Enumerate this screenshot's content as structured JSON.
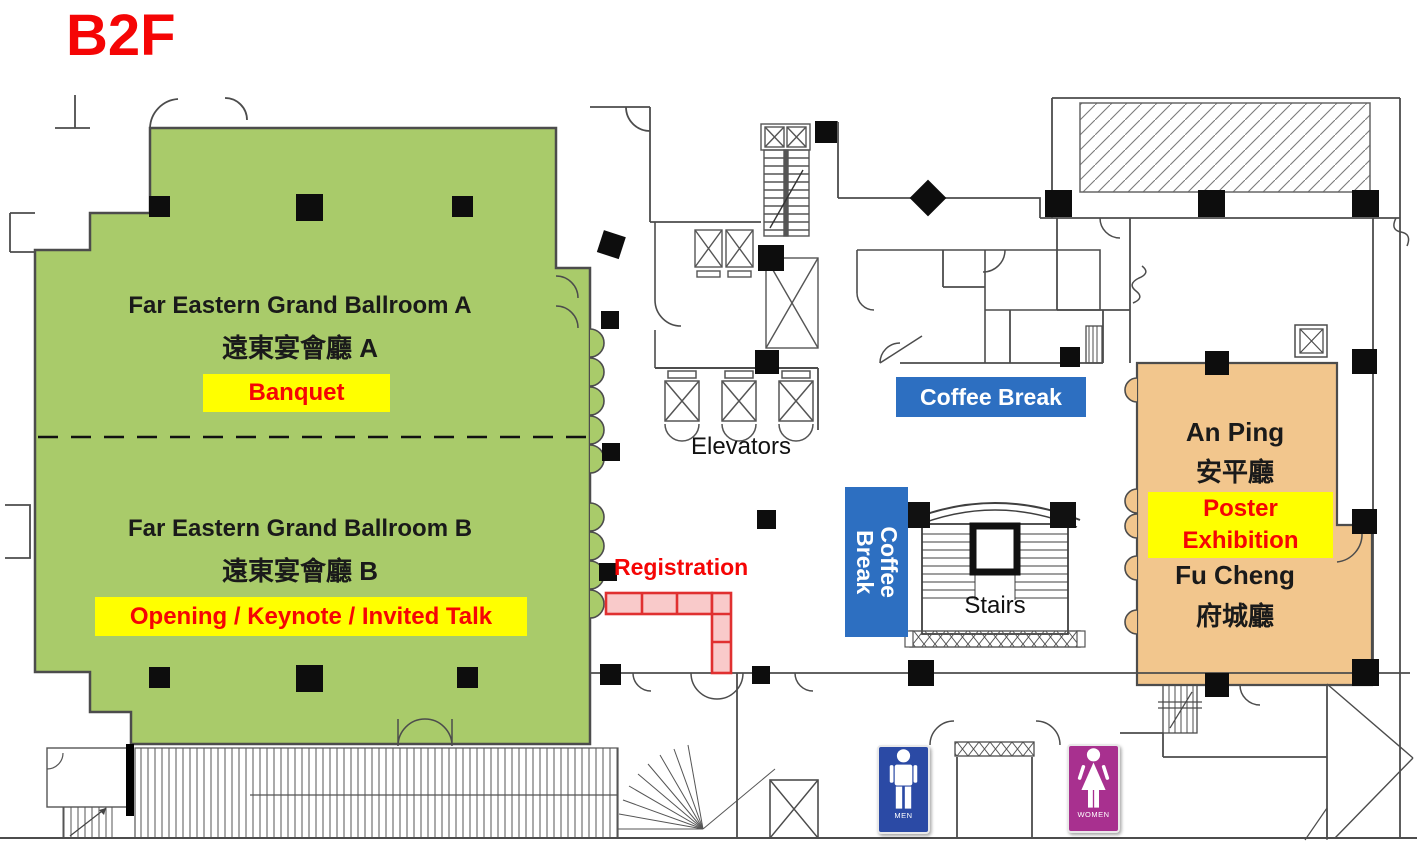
{
  "floor_label": "B2F",
  "ballroom_a": {
    "name_en": "Far Eastern Grand Ballroom A",
    "name_zh": "遠東宴會廳 A",
    "event": "Banquet"
  },
  "ballroom_b": {
    "name_en": "Far Eastern Grand Ballroom B",
    "name_zh": "遠東宴會廳 B",
    "event": "Opening / Keynote / Invited Talk"
  },
  "an_ping": {
    "name_en": "An Ping",
    "name_zh": "安平廳"
  },
  "fu_cheng": {
    "name_en": "Fu Cheng",
    "name_zh": "府城廳"
  },
  "poster_exhibition": {
    "line1": "Poster",
    "line2": "Exhibition"
  },
  "labels": {
    "elevators": "Elevators",
    "stairs": "Stairs",
    "registration": "Registration",
    "coffee_break": "Coffee Break"
  },
  "restrooms": {
    "men": "MEN",
    "women": "WOMEN"
  },
  "colors": {
    "ballroom_fill": "#a9cb6a",
    "exhibit_fill": "#f2c68d",
    "coffee_break_bg": "#2d6fc1",
    "highlight": "#ffff00",
    "accent_red": "#f50505",
    "men_sign_bg": "#2b4aa5",
    "women_sign_bg": "#a8308f",
    "registration_fill": "#f9caca",
    "registration_border": "#e03030",
    "wall": "#4c4c4c"
  }
}
